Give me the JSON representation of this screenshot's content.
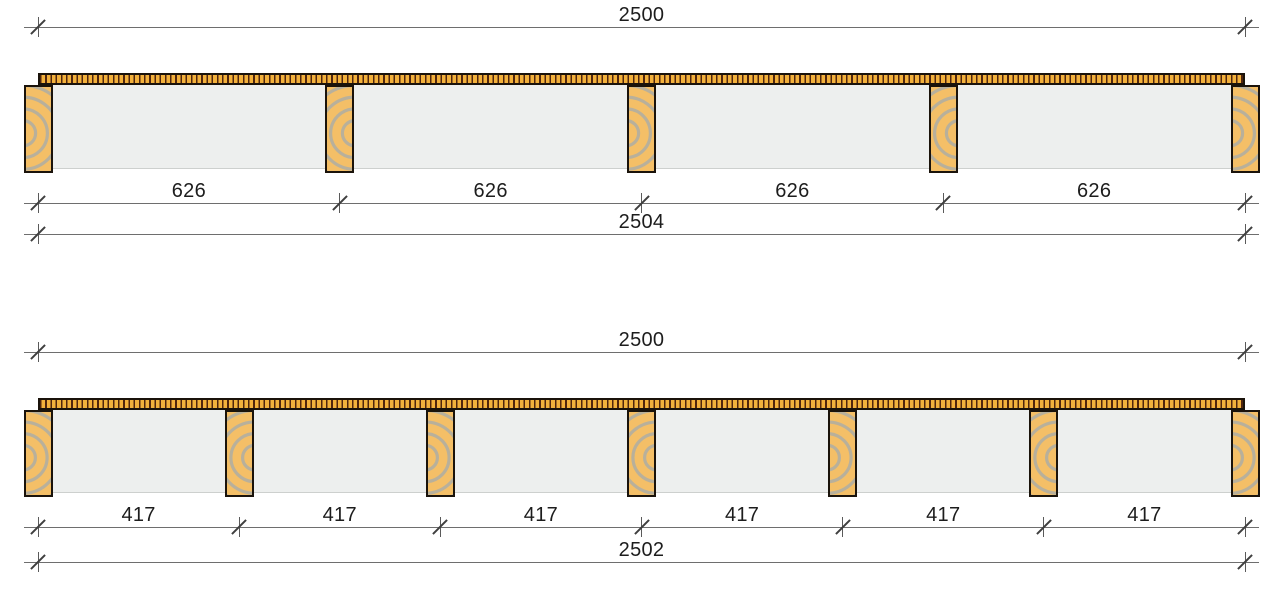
{
  "colors": {
    "background": "#ffffff",
    "deck_plank": "#f2b13c",
    "deck_gap": "#50250e",
    "joist_fill": "#f4bf67",
    "joist_grain": "#a9ada9",
    "bay_field": "#edefee",
    "outline": "#1a130b",
    "dim_line": "#6e6e6e",
    "dim_tick": "#3f3f3f",
    "text": "#1d1d1d"
  },
  "diagrams": [
    {
      "id": "joist-layout-626",
      "deck_length_label": "2500",
      "joist_count": 5,
      "spacing_labels": [
        "626",
        "626",
        "626",
        "626"
      ],
      "overall_span_label": "2504"
    },
    {
      "id": "joist-layout-417",
      "deck_length_label": "2500",
      "joist_count": 7,
      "spacing_labels": [
        "417",
        "417",
        "417",
        "417",
        "417",
        "417"
      ],
      "overall_span_label": "2502"
    }
  ]
}
